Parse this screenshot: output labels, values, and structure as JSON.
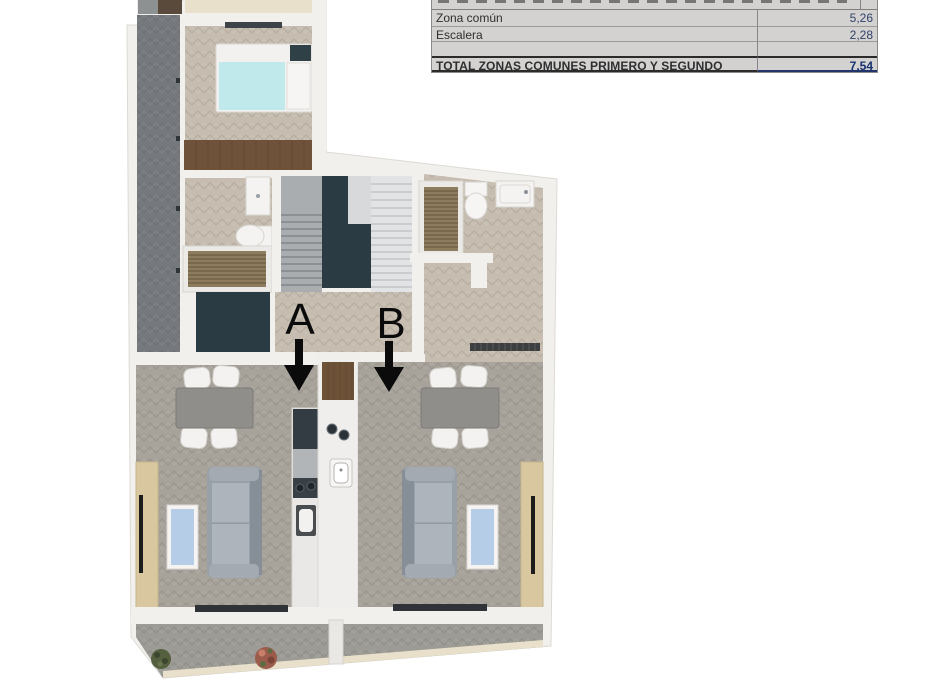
{
  "table": {
    "rows": [
      {
        "label": "Zona común",
        "value": "5,26"
      },
      {
        "label": "Escalera",
        "value": "2,28"
      },
      {
        "label": "",
        "value": ""
      }
    ],
    "total": {
      "label": "TOTAL ZONAS COMUNES PRIMERO Y SEGUNDO",
      "value": "7,54"
    }
  },
  "plan": {
    "unit_a_label": "A",
    "unit_b_label": "B"
  },
  "colors": {
    "table_bg": "#d3d2d0",
    "total_value_navy": "#15306f",
    "value_navy": "#31416b",
    "wall_white": "#f2f0ec",
    "floor_beige": "#c6bdb0",
    "floor_griege": "#a7a29a",
    "floor_corridor_gray": "#75797d",
    "floor_terrace": "#9c9b95",
    "dark_teal": "#2b3b44",
    "wood_brown": "#6d5238",
    "slat_brown": "#8d7d5e",
    "bed_cyan": "#bfe9ea",
    "window_blue": "#b5cde7",
    "cream_band": "#e9e0cb",
    "sideboard_tan": "#d8c79f",
    "arrow_black": "#0b0b0b"
  }
}
